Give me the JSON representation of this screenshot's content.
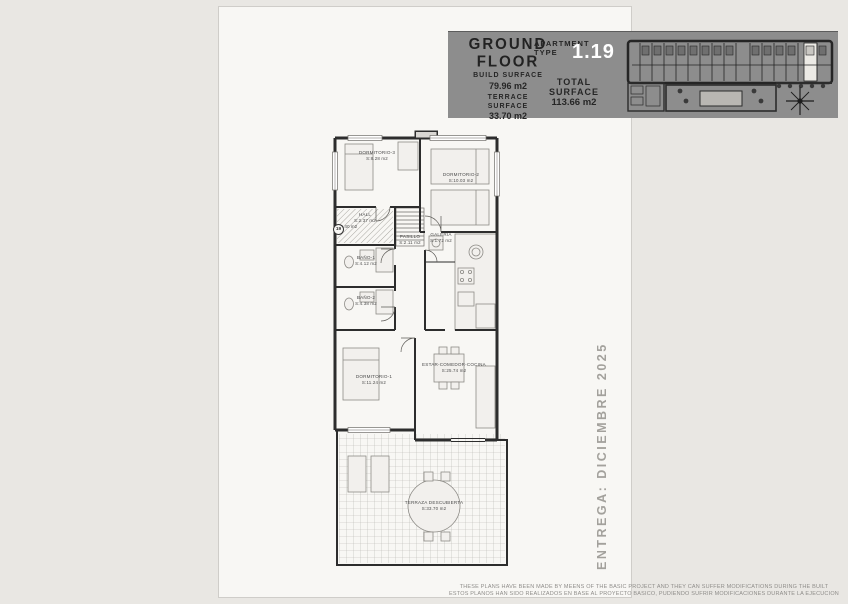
{
  "header": {
    "floor_title": "GROUND FLOOR",
    "build_surface_label": "BUILD SURFACE",
    "build_surface_value": "79.96 m2",
    "terrace_surface_label": "TERRACE SURFACE",
    "terrace_surface_value": "33.70 m2",
    "apartment_type_label": "APARTMENT TYPE",
    "apartment_type_value": "1.19",
    "total_surface_label": "TOTAL SURFACE",
    "total_surface_value": "113.66 m2"
  },
  "plan": {
    "unit_marker": "19",
    "useful_surface": "69.40 m2",
    "rooms": [
      {
        "name": "DORMITORIO-3",
        "area": "S:8.28 m2"
      },
      {
        "name": "DORMITORIO-2",
        "area": "S:10.03 m2"
      },
      {
        "name": "HALL",
        "area": "S:2.37 m2"
      },
      {
        "name": "PASILLO",
        "area": "S:2.11 m2"
      },
      {
        "name": "GALERIA",
        "area": "S:1.72 m2"
      },
      {
        "name": "BAÑO-1",
        "area": "S:4.12 m2"
      },
      {
        "name": "BAÑO-2",
        "area": "S:4.38 m2"
      },
      {
        "name": "DORMITORIO-1",
        "area": "S:11.24 m2"
      },
      {
        "name": "ESTAR-COMEDOR-COCINA",
        "area": "S:25.74 m2"
      },
      {
        "name": "TERRAZA DESCUBIERTA",
        "area": "S:33.70 m2"
      }
    ]
  },
  "delivery_text": "ENTREGA: DICIEMBRE 2025",
  "footer": {
    "line1": "THESE PLANS HAVE BEEN MADE BY MEENS OF THE BASIC PROJECT AND THEY CAN SUFFER MODIFICATIONS DURING THE BUILT",
    "line2": "ESTOS PLANOS HAN SIDO REALIZADOS EN BASE AL PROYECTO BASICO, PUDIENDO SUFRIR MODIFICACIONES DURANTE LA EJECUCION"
  },
  "colors": {
    "background": "#e9e7e3",
    "sheet": "#f8f7f4",
    "header_band": "#8d8d8d",
    "apartment_type_text": "#ffffff",
    "wall": "#2d2d2d",
    "label_text": "#4c4c4c",
    "delivery_text": "#a3a19c",
    "footer_text": "#8f8d8a"
  }
}
